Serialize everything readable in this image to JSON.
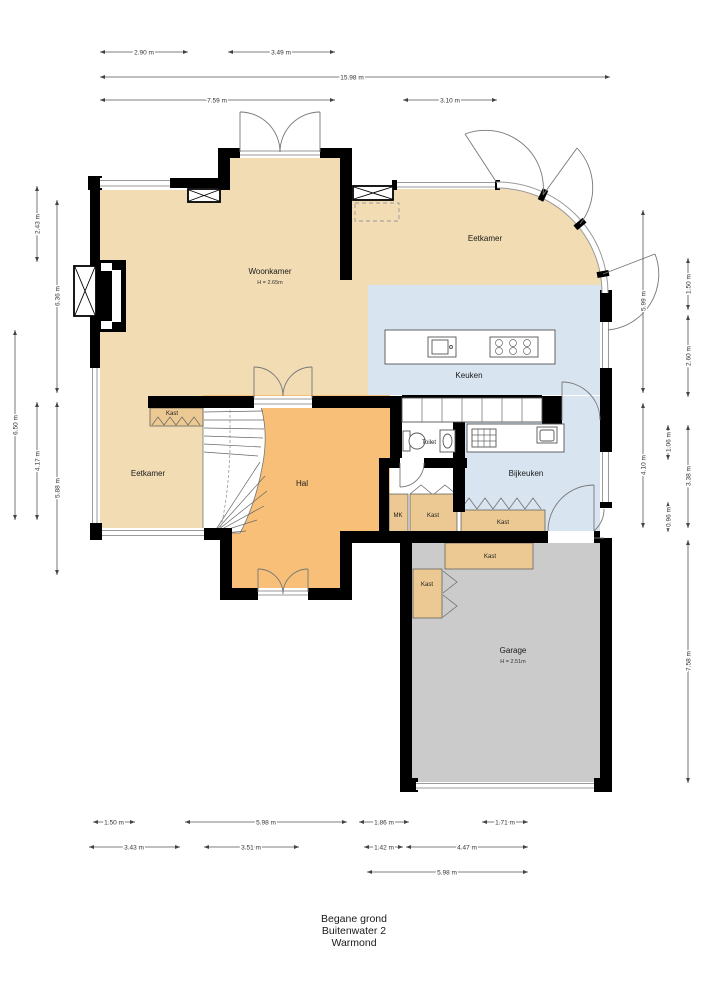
{
  "title": {
    "lines": [
      "Begane grond",
      "Buitenwater 2",
      "Warmond"
    ]
  },
  "rooms": {
    "woonkamer": {
      "label": "Woonkamer",
      "height": "H = 2.65m"
    },
    "eetkamer_top": {
      "label": "Eetkamer"
    },
    "keuken": {
      "label": "Keuken"
    },
    "toilet": {
      "label": "Toilet"
    },
    "bijkeuken": {
      "label": "Bijkeuken"
    },
    "hal": {
      "label": "Hal"
    },
    "eetkamer_left": {
      "label": "Eetkamer"
    },
    "garage": {
      "label": "Garage",
      "height": "H = 2.51m"
    },
    "kast_stairs": {
      "label": "Kast"
    },
    "kast_hal": {
      "label": "Kast"
    },
    "kast_bijkeuken": {
      "label": "Kast"
    },
    "kast_garage_top": {
      "label": "Kast"
    },
    "kast_garage_left": {
      "label": "Kast"
    },
    "mk": {
      "label": "MK"
    }
  },
  "dimensions": {
    "top": [
      {
        "label": "2.90 m"
      },
      {
        "label": "3.49 m"
      },
      {
        "label": "15.98 m"
      },
      {
        "label": "7.59 m"
      },
      {
        "label": "3.10 m"
      }
    ],
    "left": [
      {
        "label": "2.43 m"
      },
      {
        "label": "6.36 m"
      },
      {
        "label": "6.50 m"
      },
      {
        "label": "4.17 m"
      },
      {
        "label": "5.88 m"
      }
    ],
    "right": [
      {
        "label": "5.99 m"
      },
      {
        "label": "1.50 m"
      },
      {
        "label": "2.60 m"
      },
      {
        "label": "4.10 m"
      },
      {
        "label": "1.06 m"
      },
      {
        "label": "3.38 m"
      },
      {
        "label": "0.96 m"
      },
      {
        "label": "7.58 m"
      }
    ],
    "bottom": [
      {
        "label": "1.50 m"
      },
      {
        "label": "5.98 m"
      },
      {
        "label": "1.86 m"
      },
      {
        "label": "1.71 m"
      },
      {
        "label": "3.43 m"
      },
      {
        "label": "3.51 m"
      },
      {
        "label": "1.42 m"
      },
      {
        "label": "4.47 m"
      },
      {
        "label": "5.98 m"
      }
    ]
  },
  "colors": {
    "background": "#ffffff",
    "wall": "#000000",
    "living": "#f2dcb4",
    "hall": "#f7bf77",
    "kitchen": "#d8e4ef",
    "garage": "#cbcbcb",
    "closet": "#ecc992",
    "window": "#9a9a9a",
    "dimension": "#555555",
    "text": "#1a1a1a"
  }
}
